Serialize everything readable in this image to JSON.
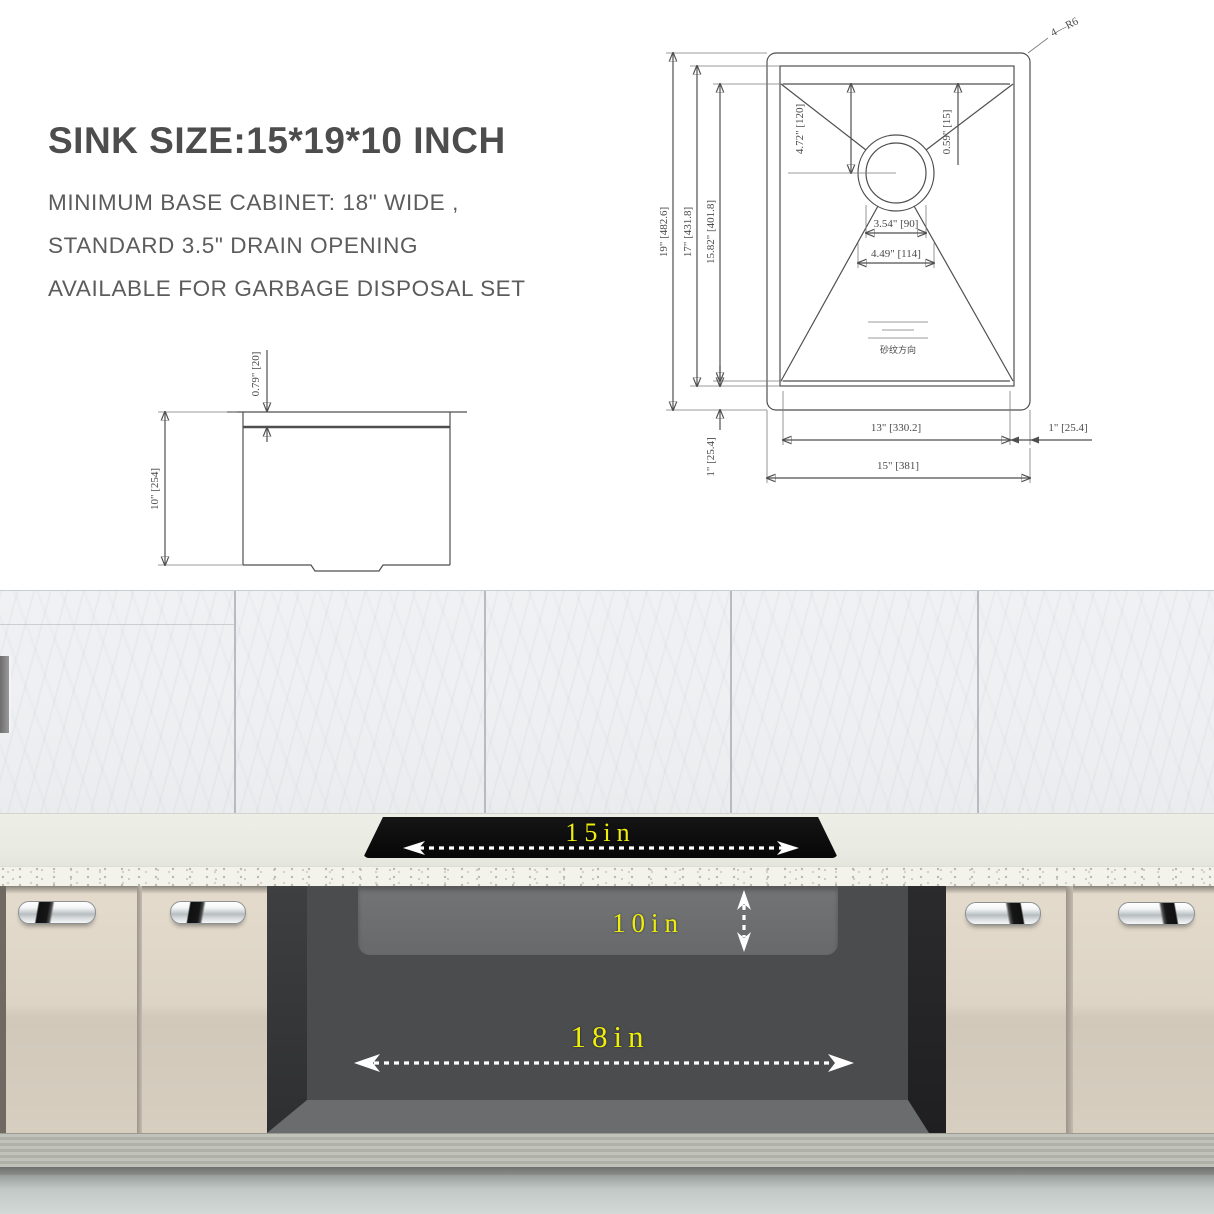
{
  "header": {
    "title": "SINK SIZE:15*19*10 INCH",
    "line1": "MINIMUM BASE CABINET: 18\" WIDE ,",
    "line2": "STANDARD 3.5\" DRAIN OPENING",
    "line3": "AVAILABLE FOR GARBAGE DISPOSAL SET"
  },
  "top_view": {
    "corner_radius_label": "4—R6",
    "overall_height": "19\" [482.6]",
    "rim_height": "17\" [431.8]",
    "bowl_height": "15.82\" [401.8]",
    "drain_from_top": "4.72\" [120]",
    "rim_width_top": "0.59\" [15]",
    "drain_diameter": "3.54\" [90]",
    "drain_outer_diameter": "4.49\" [114]",
    "bowl_width": "13\" [330.2]",
    "rim_width_right": "1\" [25.4]",
    "overall_width": "15\" [381]",
    "rim_width_bottom": "1\" [25.4]",
    "grain_direction_label": "砂纹方向"
  },
  "side_view": {
    "depth": "10\" [254]",
    "lip_height": "0.79\" [20]"
  },
  "scene_labels": {
    "sink_width": "15in",
    "sink_depth": "10in",
    "cabinet_width": "18in"
  },
  "colors": {
    "dimension_yellow": "#eeee0c",
    "sink_rim_black": "#0b0b0b",
    "drawing_line": "#4f4f4f",
    "cabinet_beige": "#d8cfc1",
    "opening_gray": "#4b4c4e"
  }
}
